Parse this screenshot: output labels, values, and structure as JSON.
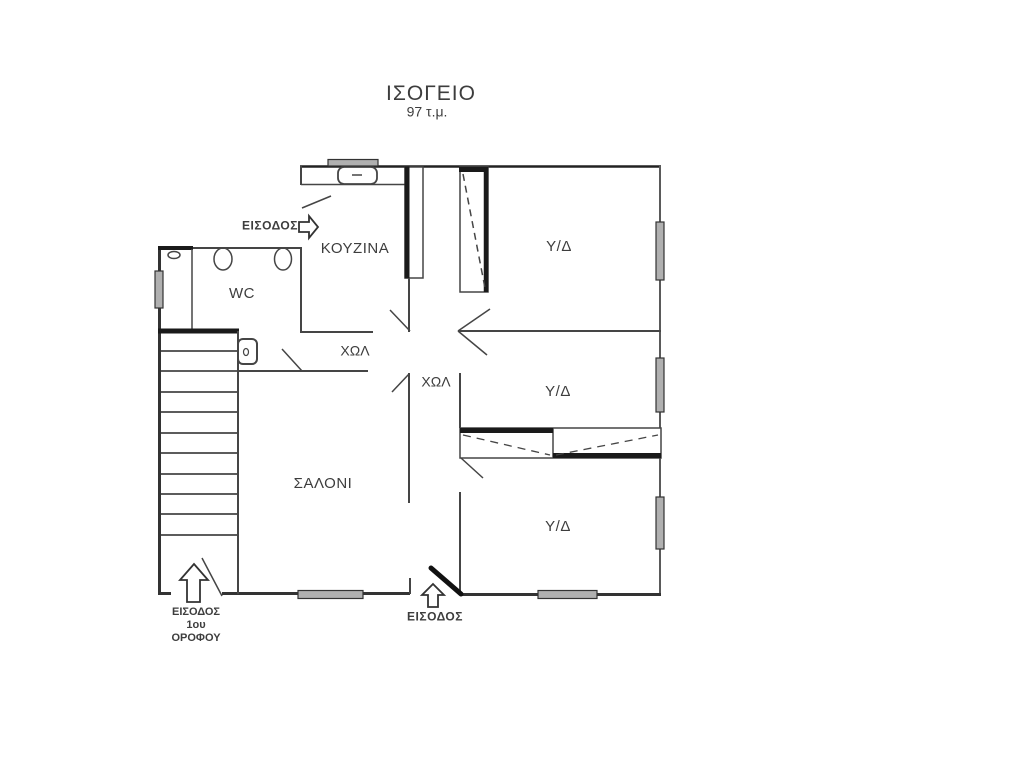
{
  "title": {
    "main": "ΙΣΟΓΕΙΟ",
    "area": "97 τ.μ."
  },
  "rooms": {
    "kitchen": "ΚΟΥΖΙΝΑ",
    "wc": "WC",
    "hall1": "ΧΩΛ",
    "hall2": "ΧΩΛ",
    "living": "ΣΑΛΟΝΙ",
    "bedroom1": "Υ/Δ",
    "bedroom2": "Υ/Δ",
    "bedroom3": "Υ/Δ"
  },
  "entrances": {
    "main_top": "ΕΙΣΟΔΟΣ",
    "main_bottom": "ΕΙΣΟΔΟΣ",
    "stairs_line1": "ΕΙΣΟΔΟΣ",
    "stairs_line2": "1ου",
    "stairs_line3": "ΟΡΟΦΟΥ"
  },
  "colors": {
    "wall": "#454545",
    "wall_dark": "#1a1a1a",
    "window_fill": "#b0b0b0",
    "text": "#3d3d3d",
    "background": "#ffffff"
  }
}
